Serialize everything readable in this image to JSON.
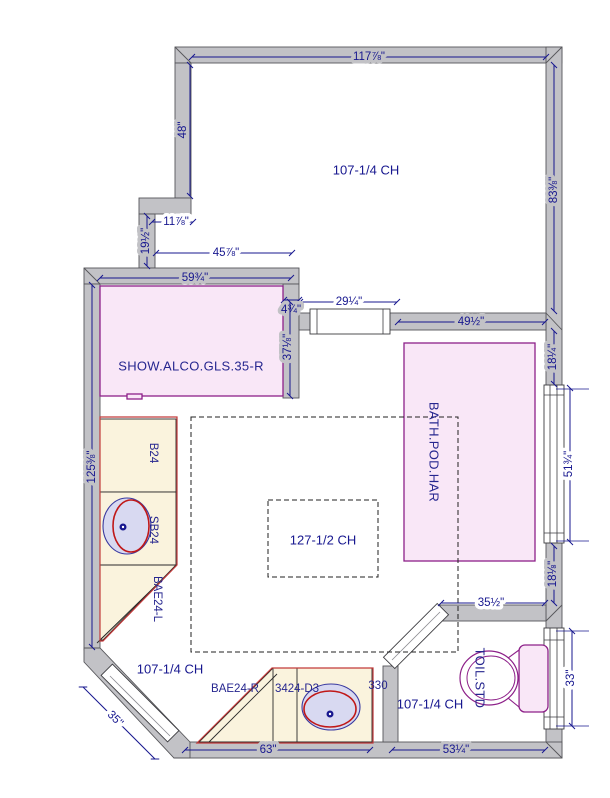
{
  "plan": {
    "ceiling": {
      "top_room": "107-1/4 CH",
      "center_room": "127-1/2 CH",
      "bottom_left_room": "107-1/4 CH",
      "toilet_room": "107-1/4 CH"
    },
    "fixtures": {
      "shower": "SHOW.ALCO.GLS.35-R",
      "bath_pod": "BATH.POD.HAR",
      "toilet": "TOIL.STD",
      "cabinet_b24": "B24",
      "cabinet_sb24": "SB24",
      "cabinet_bae24_l": "BAE24-L",
      "cabinet_bae24_r": "BAE24-R",
      "cabinet_3424_d3": "3424-D3",
      "cabinet_330": "330"
    },
    "dimensions": {
      "top_width": "117⅞\"",
      "upper_left_height": "48\"",
      "upper_right_height": "83⅜\"",
      "step_width": "11⅞\"",
      "step_height": "19½\"",
      "alcove_clear_width": "45⅞\"",
      "shower_width": "59¾\"",
      "opening_width": "29¼\"",
      "jamb_gap": "4¾\"",
      "shower_depth": "37⅛\"",
      "hall_width": "49½\"",
      "left_height": "125⅜\"",
      "right_upper_gap": "18¼\"",
      "right_window": "51¾\"",
      "right_lower_gap": "18⅛\"",
      "toilet_room_width": "35½\"",
      "toilet_window": "33\"",
      "bottom_left_width": "63\"",
      "bottom_right_width": "53¼\"",
      "diagonal_door": "35\""
    },
    "colors": {
      "wall_fill": "#c2c2c6",
      "dimension_blue": "#17178f",
      "fixture_pink": "#f9e7f7",
      "fixture_purple": "#8d2089",
      "cabinet_cream": "#faf3dd",
      "cabinet_red": "#c23a3a",
      "sink_lavender": "#d8d9f1"
    }
  }
}
